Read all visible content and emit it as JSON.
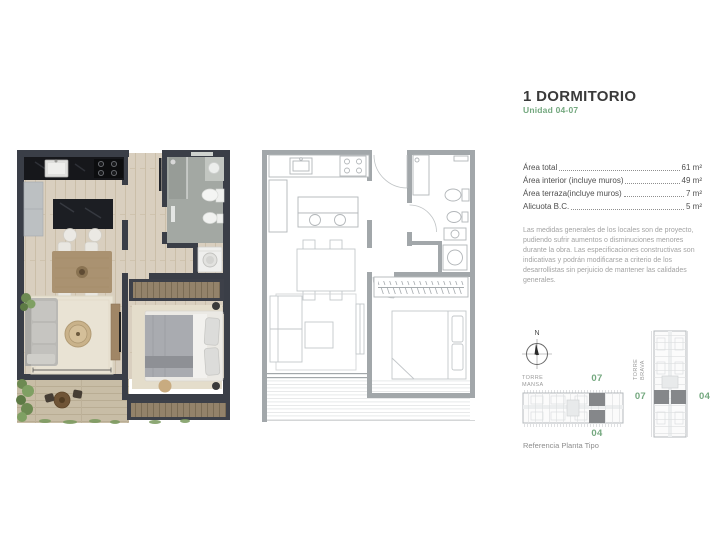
{
  "header": {
    "title": "1 DORMITORIO",
    "subtitle": "Unidad 04-07"
  },
  "areas": [
    {
      "label": "Área total",
      "value": "61 m²"
    },
    {
      "label": "Área interior (incluye muros)",
      "value": "49 m²"
    },
    {
      "label": "Área terraza(incluye muros)",
      "value": "7 m²"
    },
    {
      "label": "Alicuota B.C.",
      "value": "5 m²"
    }
  ],
  "disclaimer": "Las medidas generales de los locales son de proyecto, pudiendo sufrir aumentos o disminuciones menores durante la obra. Las especificaciones constructivas son indicativas y podrán modificarse a criterio de los desarrollistas sin perjuicio de mantener las calidades generales.",
  "compass": {
    "north_label": "N"
  },
  "towers": {
    "mansa": {
      "name": "TORRE\nMANSA",
      "unit_top": "07",
      "unit_bottom": "04"
    },
    "brava": {
      "name": "TORRE\nBRAVA",
      "unit_left": "07",
      "unit_right": "04"
    }
  },
  "reference_caption": "Referencia Planta Tipo",
  "colors": {
    "accent_green": "#74a87f",
    "render_wall": "#3a3e47",
    "line_wall": "#a2a7aa",
    "wood_floor": "#d9cfbf",
    "terrace_floor": "#c8bda6",
    "bath_floor": "#a3a8a3",
    "highlight_unit": "#85878a"
  }
}
